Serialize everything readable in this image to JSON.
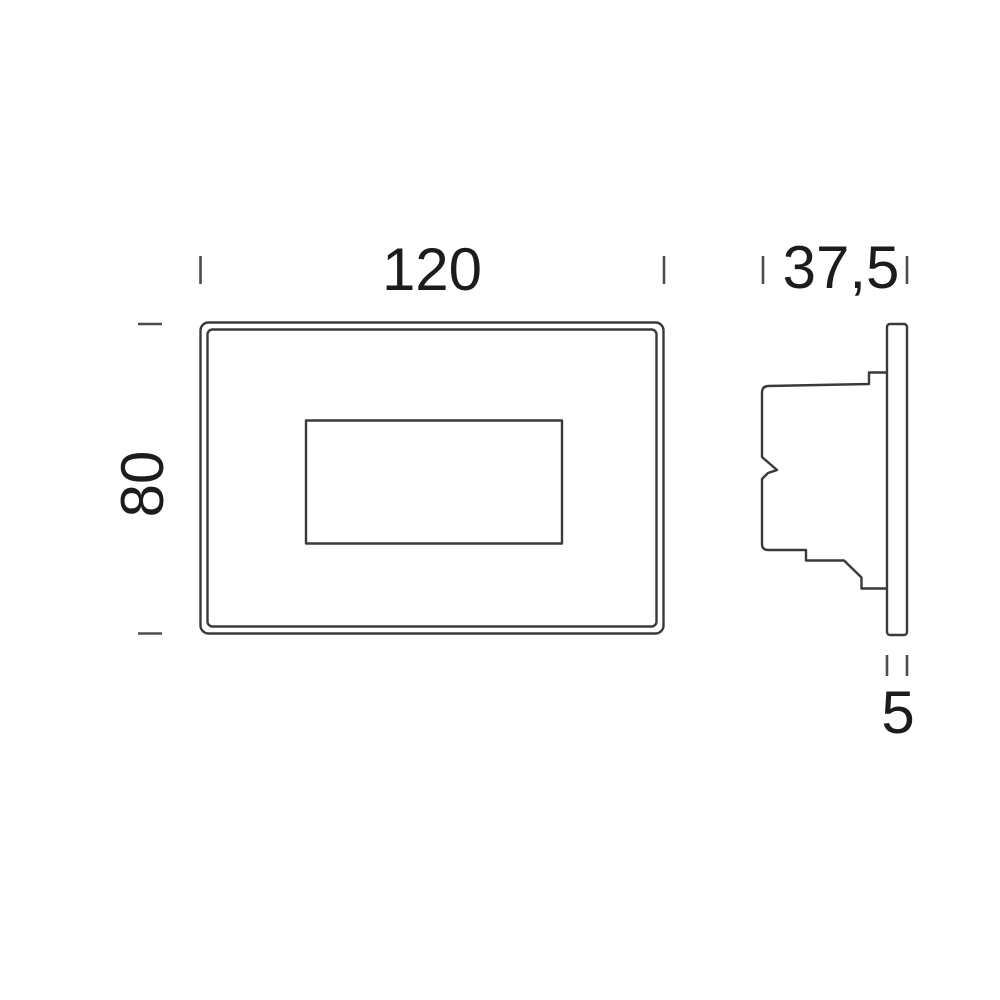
{
  "drawing": {
    "dimensions": {
      "width_label": "120",
      "height_label": "80",
      "depth_label": "37,5",
      "thickness_label": "5"
    },
    "colors": {
      "line": "#3a3a3a",
      "tick": "#4d4d4d",
      "text": "#1c1c1c",
      "background": "#ffffff"
    }
  }
}
